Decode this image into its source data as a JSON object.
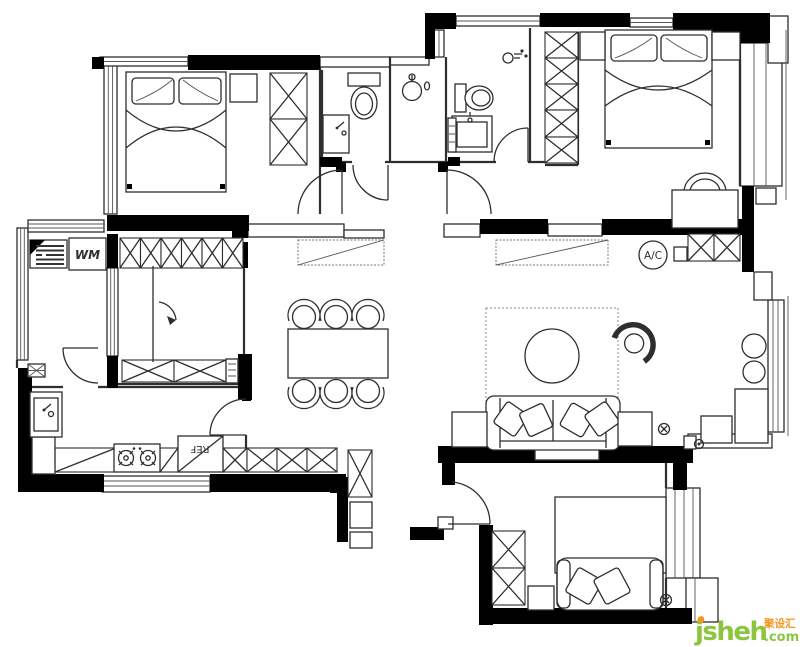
{
  "plan": {
    "labels": {
      "washing_machine": "WM",
      "refrigerator": "REF",
      "air_conditioner": "A/C"
    }
  },
  "watermark": {
    "brand": "jsheh",
    "suffix": ".com",
    "badge": "聚设汇",
    "brand_color": "#8cc63e",
    "accent_color": "#f7941d"
  },
  "colors": {
    "wall": "#000000",
    "line": "#2e2e2e"
  }
}
